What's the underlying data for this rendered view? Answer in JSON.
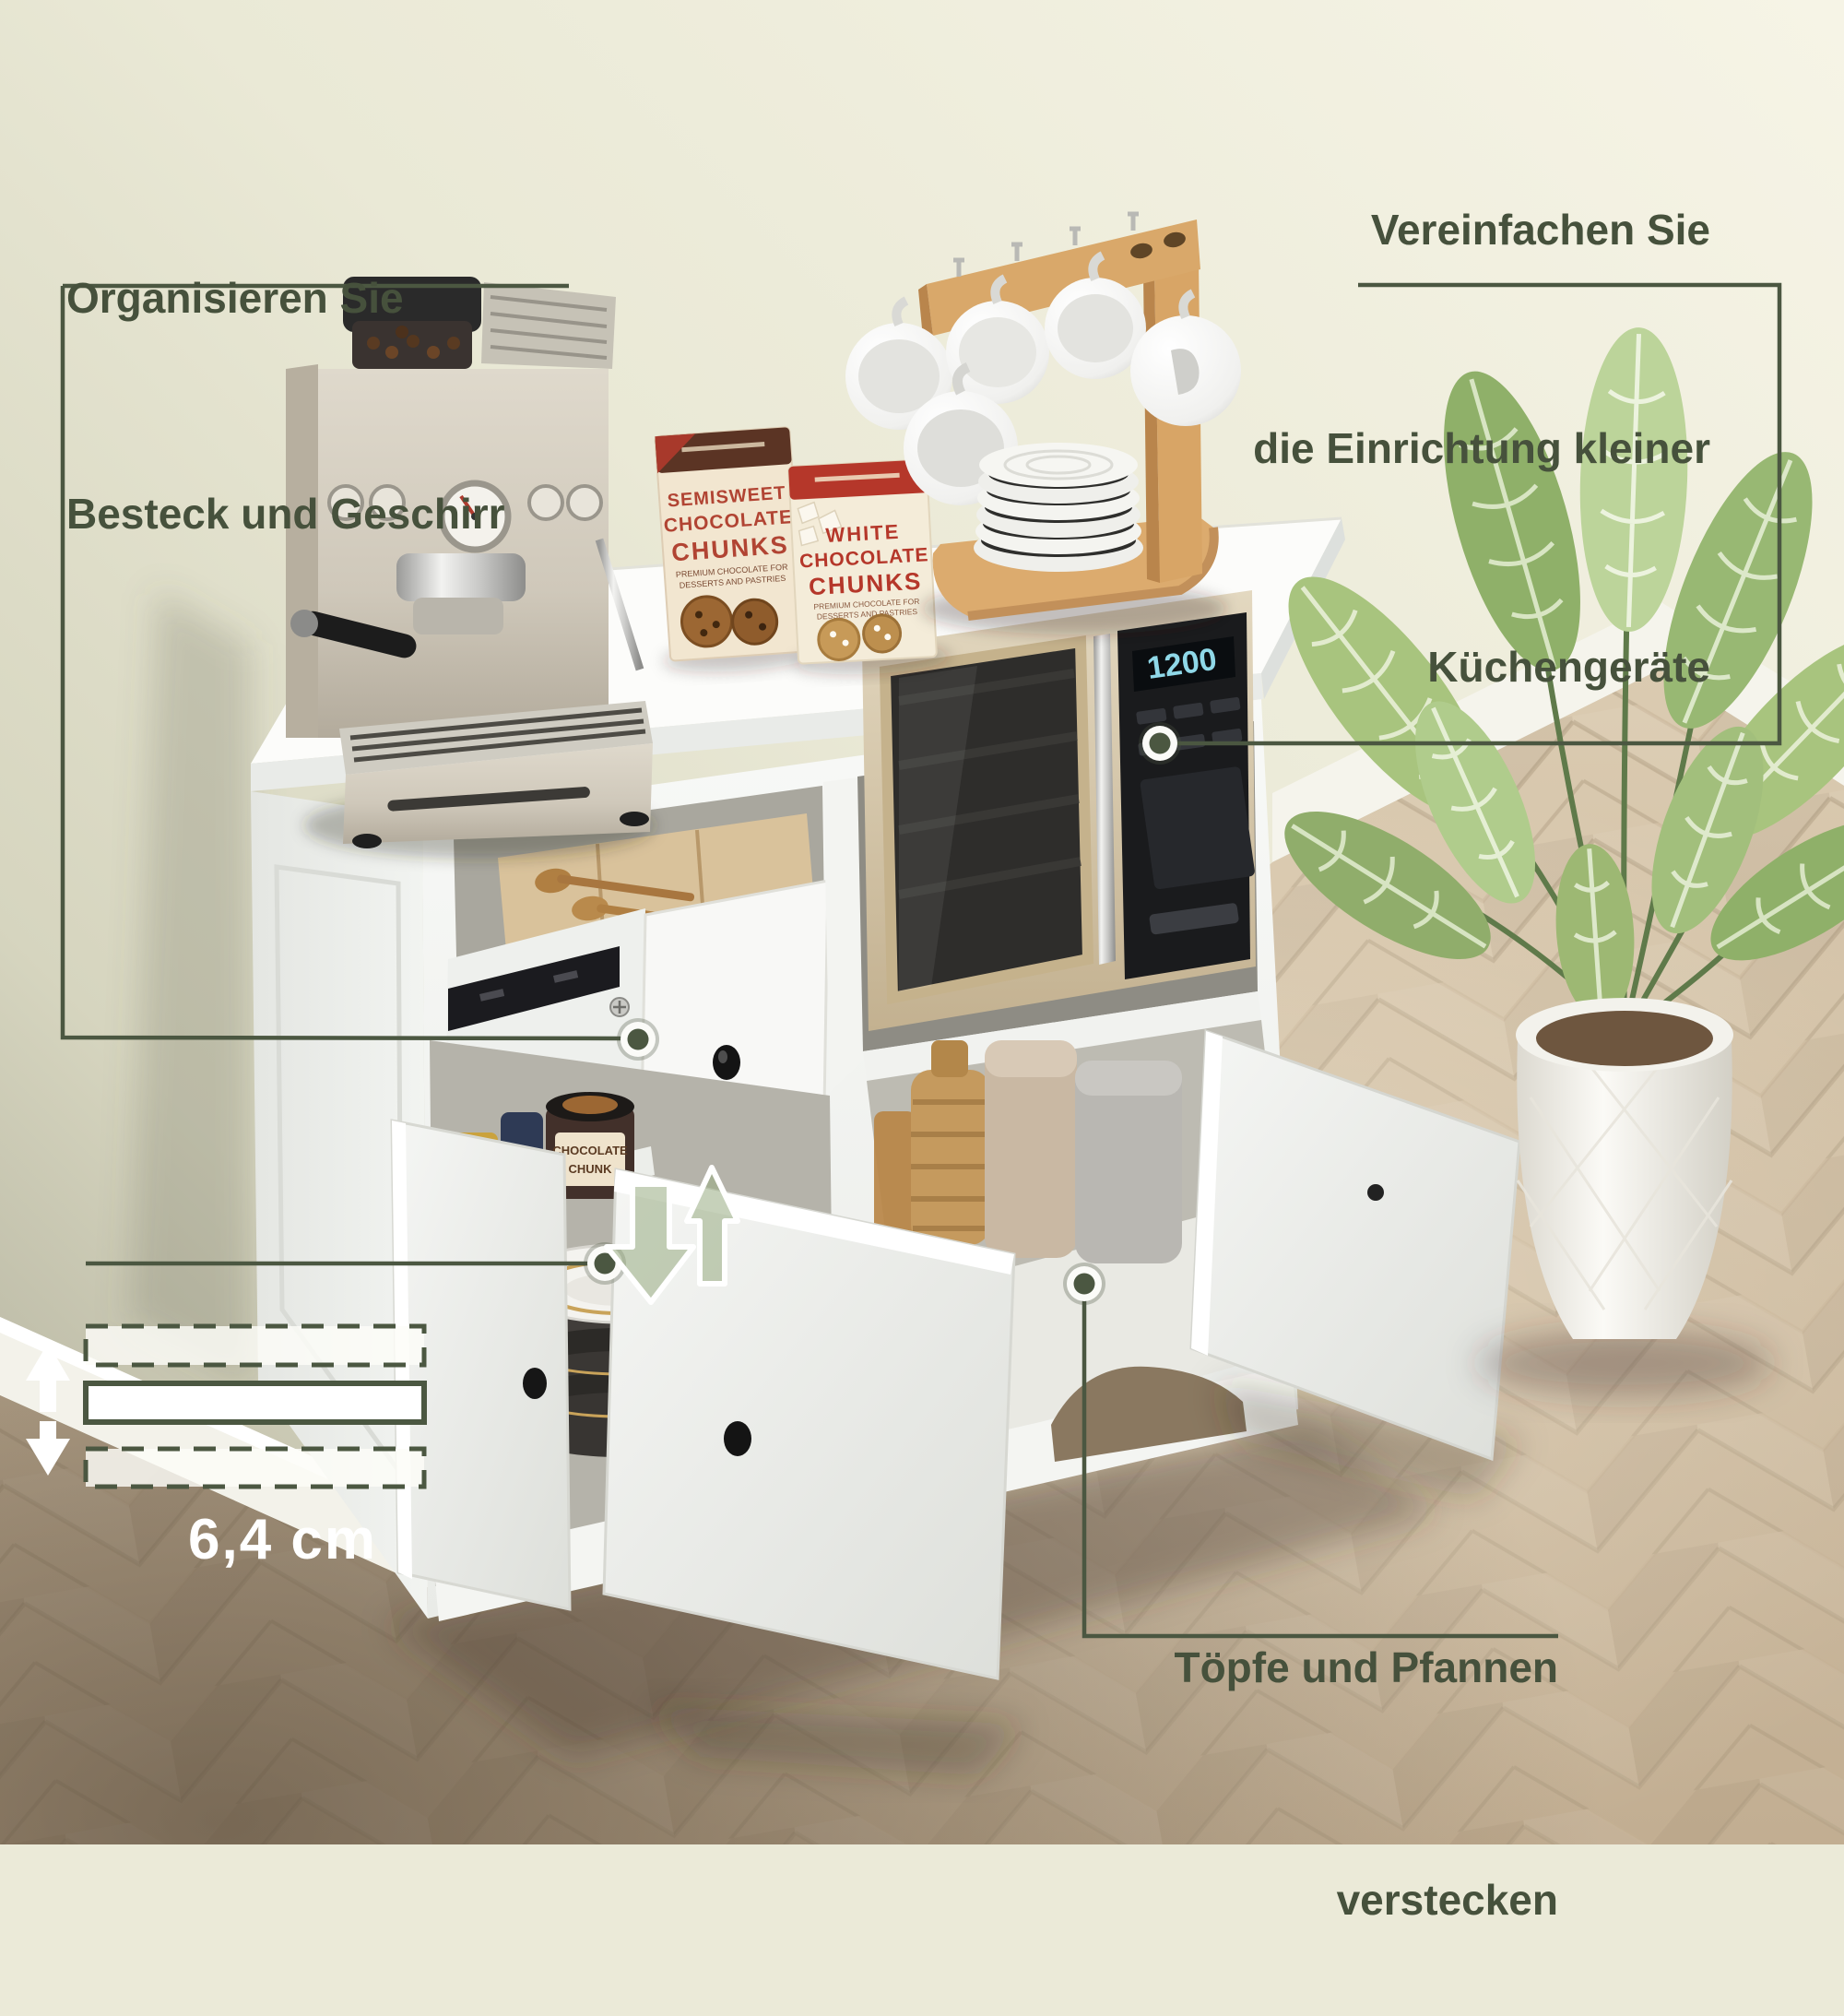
{
  "annotations": {
    "text_color": "#46513c",
    "line_color": "#4b5741",
    "top_left": {
      "lines": [
        "Organisieren Sie",
        "Besteck und Geschirr"
      ]
    },
    "top_right": {
      "lines": [
        "Vereinfachen Sie",
        "die Einrichtung kleiner",
        "Küchengeräte"
      ]
    },
    "bottom_right": {
      "lines": [
        "Töpfe und Pfannen",
        "verstecken"
      ]
    },
    "measurement_label": "6,4 cm"
  },
  "products": {
    "semisweet_box": {
      "title_lines": [
        "SEMISWEET",
        "CHOCOLATE",
        "CHUNKS"
      ],
      "subtitle_lines": [
        "PREMIUM CHOCOLATE FOR",
        "DESSERTS AND PASTRIES"
      ]
    },
    "white_box": {
      "title_lines": [
        "WHITE",
        "CHOCOLATE",
        "CHUNKS"
      ],
      "subtitle_lines": [
        "PREMIUM CHOCOLATE FOR",
        "DESSERTS AND PASTRIES"
      ]
    },
    "cookie_jar": {
      "line1": "CHOCOLATE",
      "line2": "CHUNK"
    }
  },
  "appliances": {
    "microwave_display": "1200"
  },
  "scene_colors": {
    "wall": "#ebead8",
    "floor": "#cdbba1",
    "cabinet": "#f6f7f5",
    "wood_accent": "#d9a86a",
    "plant_green": "#9db873"
  }
}
